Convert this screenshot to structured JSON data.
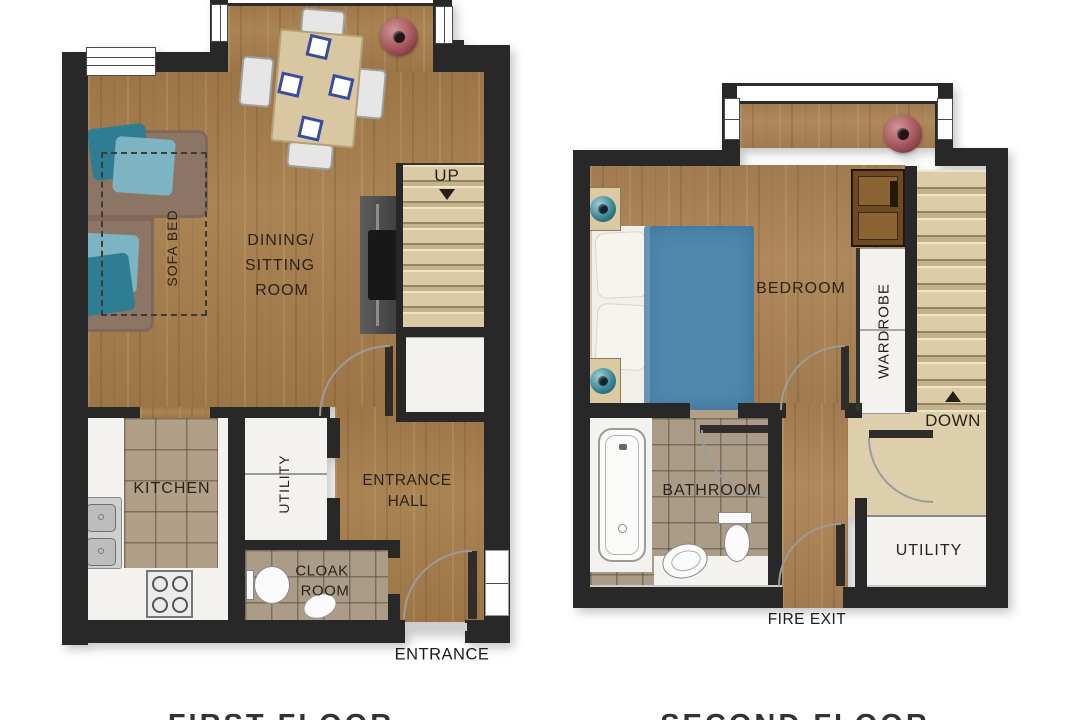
{
  "first_floor": {
    "caption": "FIRST FLOOR",
    "labels": {
      "dining_line1": "DINING/",
      "dining_line2": "SITTING",
      "dining_line3": "ROOM",
      "sofa_bed": "SOFA BED",
      "up": "UP",
      "kitchen": "KITCHEN",
      "utility": "UTILITY",
      "entrance_hall_line1": "ENTRANCE",
      "entrance_hall_line2": "HALL",
      "cloak_line1": "CLOAK",
      "cloak_line2": "ROOM",
      "entrance": "ENTRANCE"
    },
    "icons": [
      "stairs-up-arrow-icon"
    ]
  },
  "second_floor": {
    "caption": "SECOND FLOOR",
    "labels": {
      "bedroom": "BEDROOM",
      "wardrobe": "WARDROBE",
      "down": "DOWN",
      "bathroom": "BATHROOM",
      "utility": "UTILITY",
      "fire_exit": "FIRE EXIT"
    },
    "icons": [
      "stairs-down-arrow-icon"
    ]
  },
  "colors": {
    "wall": "#282828",
    "wood1": "#a67d4b",
    "wood2": "#ab8354",
    "tile": "#b29f87",
    "white_room": "#f3f2ef",
    "landing": "#decfac",
    "sofa": "#8d7565",
    "cushion_dark": "#2e7d93",
    "cushion_light": "#7db4c3",
    "bed_blue": "#4e88ae",
    "table_wood": "#d9c7a2",
    "accent_red": "#a3545b",
    "lamp_teal": "#3e8796",
    "label": "#2b231a"
  }
}
